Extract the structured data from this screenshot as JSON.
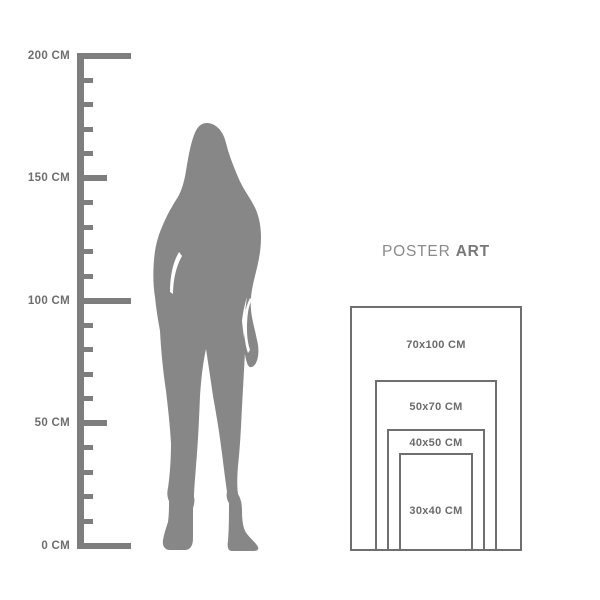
{
  "background": "#ffffff",
  "ruler": {
    "unit": "CM",
    "min_value": 0,
    "max_value": 200,
    "minor_step_cm": 10,
    "labeled_step_cm": 50,
    "labels": [
      "200 CM",
      "150 CM",
      "100 CM",
      "50 CM",
      "0 CM"
    ],
    "label_values": [
      200,
      150,
      100,
      50,
      0
    ],
    "color": "#7e7e7e",
    "label_color": "#6e6e6e"
  },
  "figure": {
    "name": "standing-woman-silhouette",
    "color": "#878787"
  },
  "brand": {
    "text": "POSTER ART",
    "word_regular": "POSTER",
    "word_bold": "ART",
    "color_regular": "#8a8a8a",
    "color_bold": "#787878"
  },
  "poster_sizes": {
    "frame_color": "#6f6f6f",
    "label_color": "#6b6b6b",
    "items": [
      {
        "label": "70x100 CM",
        "width_cm": 70,
        "height_cm": 100
      },
      {
        "label": "50x70 CM",
        "width_cm": 50,
        "height_cm": 70
      },
      {
        "label": "40x50 CM",
        "width_cm": 40,
        "height_cm": 50
      },
      {
        "label": "30x40 CM",
        "width_cm": 30,
        "height_cm": 40
      }
    ]
  }
}
